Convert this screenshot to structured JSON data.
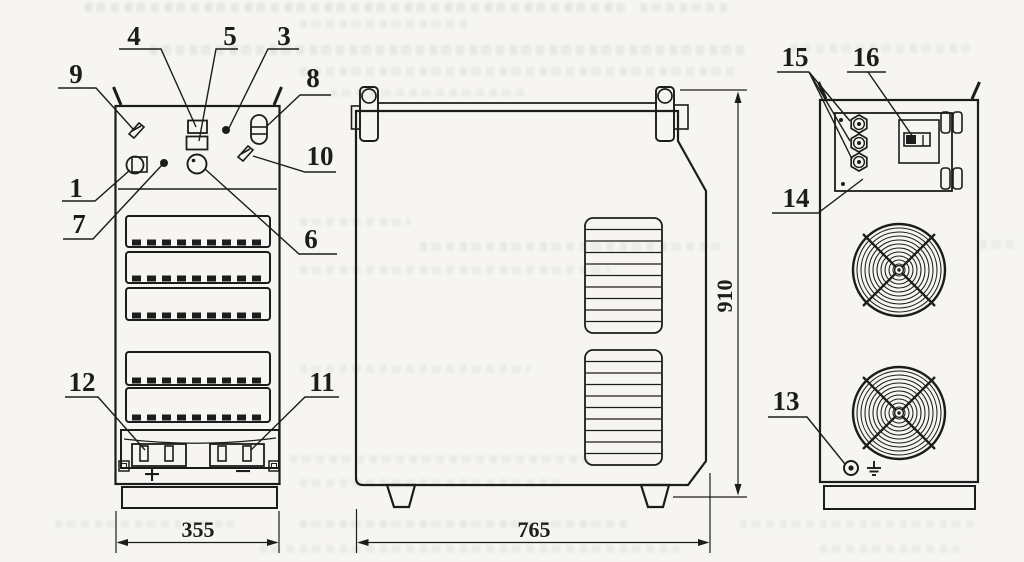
{
  "drawing_kind": "equipment-outline-drawing",
  "colors": {
    "ink": "#1c1c1c",
    "paper": "#f6f5f1"
  },
  "callouts": {
    "n1": "1",
    "n3": "3",
    "n4": "4",
    "n5": "5",
    "n6": "6",
    "n7": "7",
    "n8": "8",
    "n9": "9",
    "n10": "10",
    "n11": "11",
    "n12": "12",
    "n13": "13",
    "n14": "14",
    "n15": "15",
    "n16": "16"
  },
  "dimensions": {
    "front_width": "355",
    "side_depth": "765",
    "overall_height": "910"
  },
  "terminal_labels": {
    "positive": "+",
    "negative": "−"
  },
  "icon_names": [
    "earth-ground-icon",
    "fan-grille",
    "carry-handle",
    "vent-louvers"
  ]
}
